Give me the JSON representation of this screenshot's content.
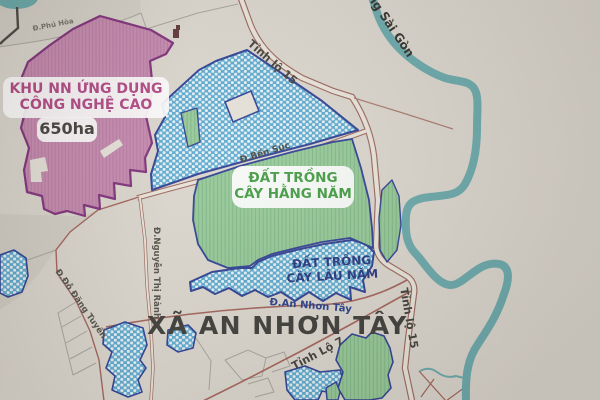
{
  "map": {
    "zones": {
      "hi_tech": {
        "line1": "KHU NN ỨNG DỤNG",
        "line2": "CÔNG NGHỆ CAO",
        "area_badge": "650ha",
        "fill": "#c689ae",
        "border": "#7d2d7a",
        "label_color": "#b04583"
      },
      "annual_crops": {
        "line1": "ĐẤT TRỒNG",
        "line2": "CÂY HẰNG NĂM",
        "fill": "#95c997",
        "border": "#2b3d92",
        "label_color": "#3f9a3f"
      },
      "perennial_crops": {
        "line1": "ĐẤT TRỒNG",
        "line2": "CÂY LÂU NĂM",
        "fill": "#58a9d0",
        "border": "#2b3d92",
        "label_color": "#23337f"
      },
      "commune": {
        "name": "XÃ AN NHƠN TÂY",
        "label_color": "#3a3a36"
      }
    },
    "roads": {
      "tinh_lo_15": "Tỉnh lộ 15",
      "tinh_lo_7": "Tỉnh Lộ 7",
      "ben_suc": "Đ.Bến Súc",
      "an_nhon_tay": "Đ.An Nhơn Tây",
      "nguyen_thi_ranh": "Đ.Nguyễn Thị Rành",
      "do_dang_tuyen": "Đ.Đỗ Đăng Tuyển",
      "phu_hoa": "Đ.Phú Hòa",
      "road_color": "#9a655b"
    },
    "water": {
      "river_name": "Sông Sài Gòn",
      "color": "#68a9ac"
    },
    "background_color": "#dbd7ce"
  }
}
